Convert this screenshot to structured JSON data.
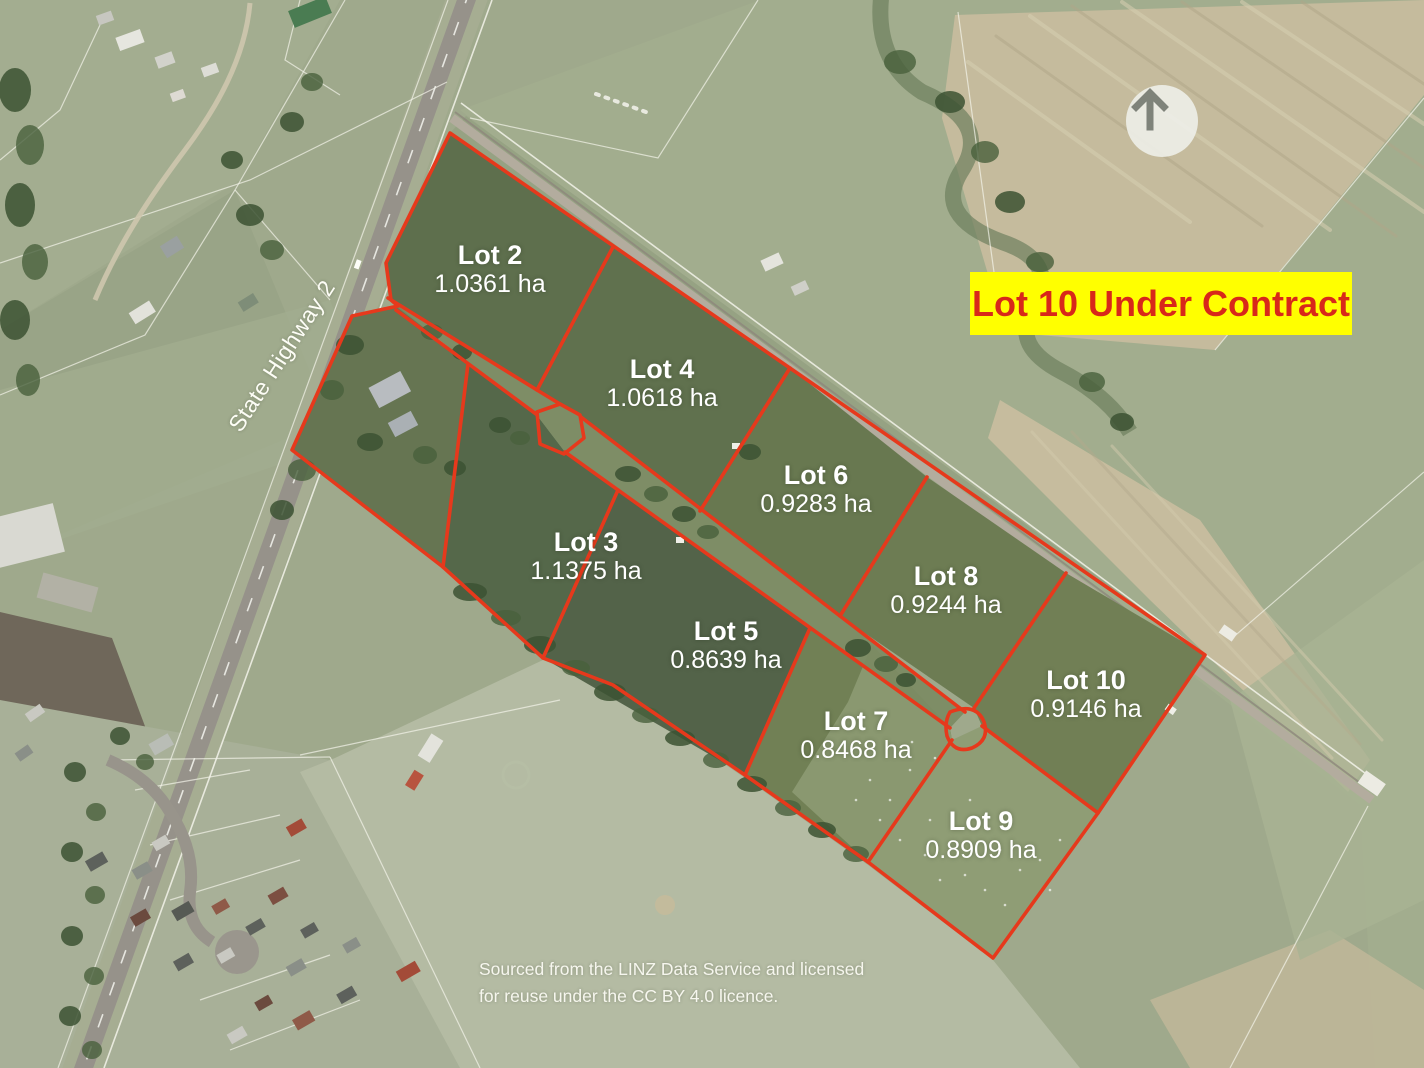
{
  "banner": {
    "text": "Lot 10 Under Contract",
    "background": "#ffff00",
    "text_color": "#d8281a"
  },
  "road_label": "State Highway 2",
  "attribution": {
    "line1": "Sourced from the LINZ Data Service and licensed",
    "line2": "for reuse under the CC BY 4.0 licence."
  },
  "colors": {
    "boundary": "#e6391c",
    "label_text": "#ffffff"
  },
  "lots": [
    {
      "name": "Lot 2",
      "area": "1.0361 ha"
    },
    {
      "name": "Lot 4",
      "area": "1.0618 ha"
    },
    {
      "name": "Lot 6",
      "area": "0.9283 ha"
    },
    {
      "name": "Lot 8",
      "area": "0.9244 ha"
    },
    {
      "name": "Lot 10",
      "area": "0.9146 ha"
    },
    {
      "name": "Lot 3",
      "area": "1.1375 ha"
    },
    {
      "name": "Lot 5",
      "area": "0.8639 ha"
    },
    {
      "name": "Lot 7",
      "area": "0.8468 ha"
    },
    {
      "name": "Lot 9",
      "area": "0.8909 ha"
    }
  ]
}
